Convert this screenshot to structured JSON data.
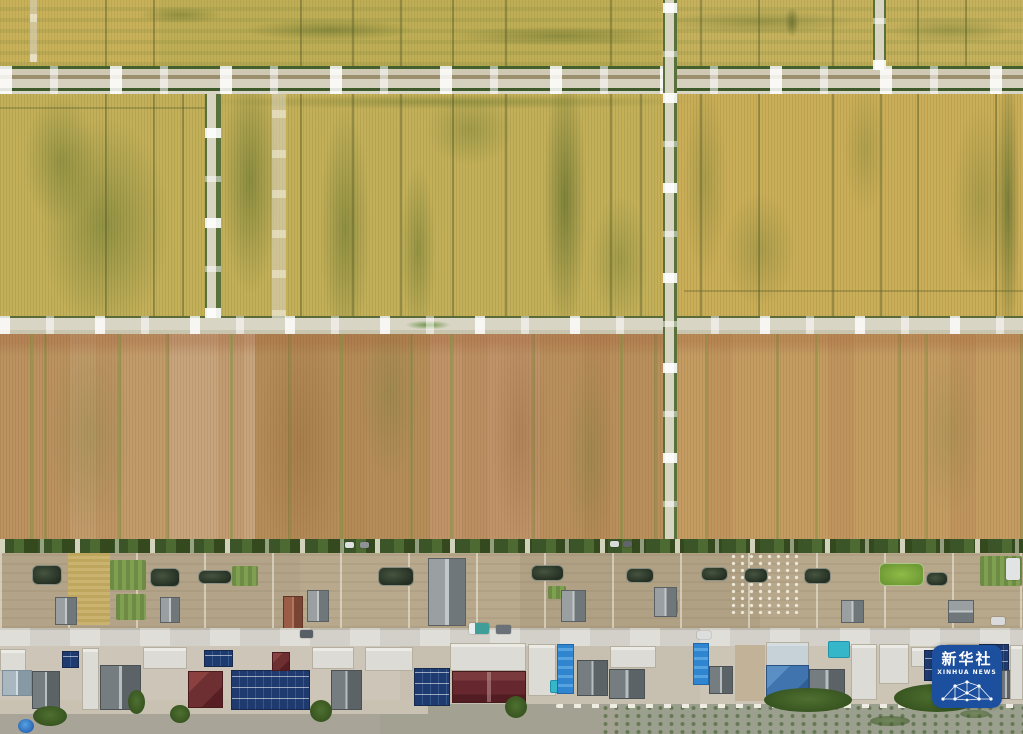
{
  "scene": {
    "description": "Aerial drone photograph of a plain: grid of ripening golden-green wheat fields divided by pale farm roads and ditches, a village strip with backyard gardens and ponds, a street, a row of houses with rooftop solar panels, and a river along the bottom edge",
    "regions": {
      "fields_top": "wheat fields, gold with green streaks",
      "fields_middle": "large wheat field block, gold-green mottled",
      "fields_lower": "harvest-ready tan and brown field strips",
      "village": "backyards with ponds, gardens, sheds and drying grain",
      "street": "concrete village street with parked vehicles",
      "houses": "row of farmhouses: flat white roofs, gray gable roofs, red and blue hip roofs, blue solar arrays",
      "river": "khaki river water with floating vegetation"
    },
    "colors": {
      "field_gold": "#c8b45e",
      "field_green_streak": "#7a8a44",
      "field_brown": "#b98f5c",
      "road_pale": "#d8d4c2",
      "ditch_green": "#44602c",
      "hedge_green": "#3c5528",
      "yard_soil": "#b5a58a",
      "street_gray": "#d2d0c8",
      "river_khaki": "#a2a192",
      "solar_blue": "#1e3a6e",
      "roof_red": "#6d2f31",
      "roof_maroon": "#66282e",
      "roof_blue": "#3f74ae",
      "pool_teal": "#36b6c9"
    }
  },
  "watermark": {
    "title": "新华社",
    "subtitle": "XINHUA NEWS",
    "bg_color": "#1c4f9d",
    "text_color": "#ffffff"
  }
}
